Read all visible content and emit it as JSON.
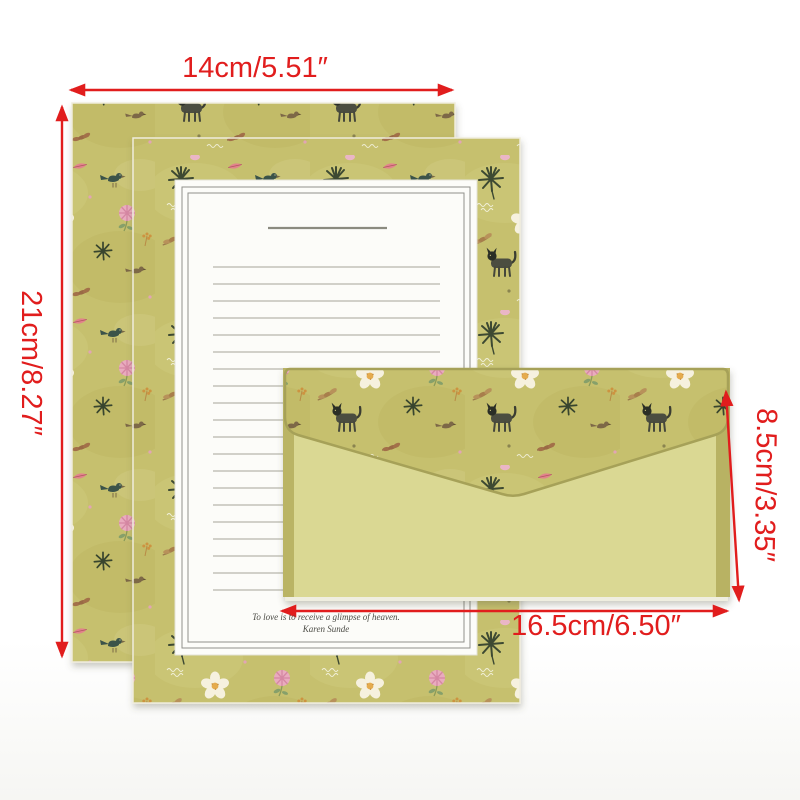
{
  "photo": {
    "dimension_labels": {
      "paper_width": "14cm/5.51″",
      "paper_height": "21cm/8.27″",
      "envelope_height": "8.5cm/3.35″",
      "envelope_width": "16.5cm/6.50″"
    },
    "letter_paper": {
      "quote": "To love is to receive a glimpse of heaven.",
      "author": "Karen Sunde"
    },
    "colors": {
      "annotation_red": "#e11d1d",
      "pattern_olive": "#c6c06e",
      "envelope_body": "#dad893",
      "envelope_trim": "#b8b263",
      "writing_panel": "#fcfcf9"
    }
  }
}
